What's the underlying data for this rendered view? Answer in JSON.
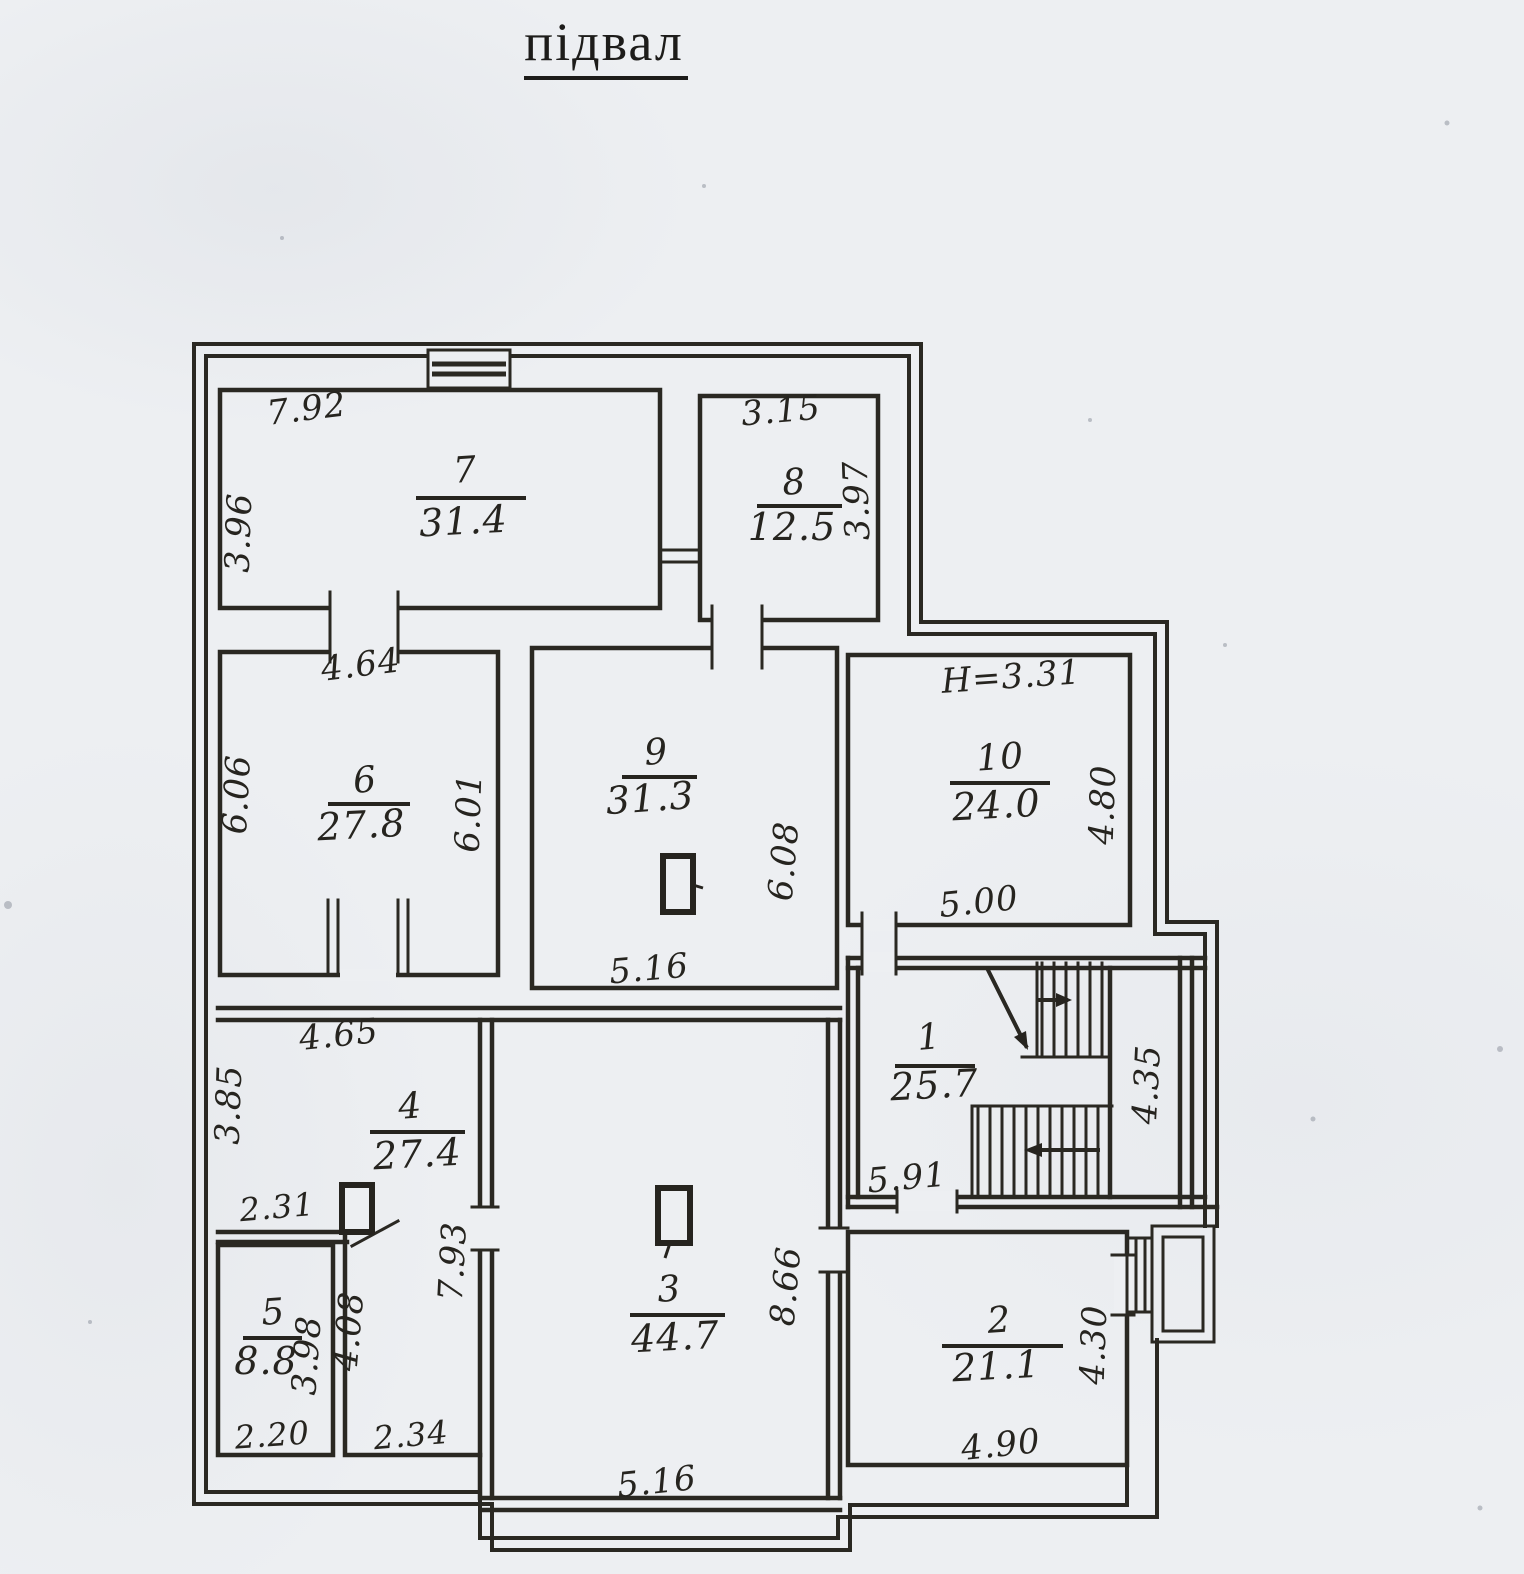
{
  "title": "підвал",
  "floor_plan": {
    "floor_name": "підвал",
    "paper_color": "#edeff2",
    "ink_color": "#26241f",
    "rooms": [
      {
        "number": "7",
        "area": "31.4"
      },
      {
        "number": "8",
        "area": "12.5"
      },
      {
        "number": "6",
        "area": "27.8"
      },
      {
        "number": "9",
        "area": "31.3"
      },
      {
        "number": "10",
        "area": "24.0"
      },
      {
        "number": "4",
        "area": "27.4"
      },
      {
        "number": "5",
        "area": "8.8"
      },
      {
        "number": "3",
        "area": "44.7"
      },
      {
        "number": "1",
        "area": "25.7"
      },
      {
        "number": "2",
        "area": "21.1"
      }
    ],
    "dimensions": {
      "room7_top": "7.92",
      "room7_left": "3.96",
      "room8_top": "3.15",
      "room8_right": "3.97",
      "room6_top": "4.64",
      "room6_left": "6.06",
      "room6_right": "6.01",
      "room9_bottom": "5.16",
      "room9_right": "6.08",
      "room10_height_note": "H=3.31",
      "room10_right": "4.80",
      "room10_bottom": "5.00",
      "room4_top": "4.65",
      "room4_left": "3.85",
      "room4_bottom_left": "2.31",
      "corridor_wall": "7.93",
      "room5_right": "3.98",
      "room5_bottom": "2.20",
      "corridor_height": "4.08",
      "corridor_bottom": "2.34",
      "room3_right": "8.66",
      "room3_bottom": "5.16",
      "room1_bottom": "5.91",
      "stair_strip_right": "4.35",
      "room2_bottom": "4.90",
      "room2_right": "4.30"
    }
  }
}
